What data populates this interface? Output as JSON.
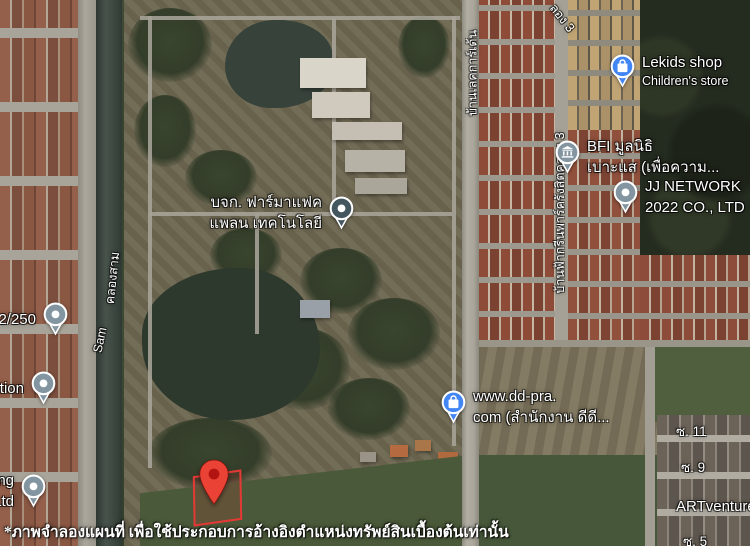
{
  "map": {
    "view": "satellite",
    "disclaimer": "*ภาพจำลองแผนที่ เพื่อใช้ประกอบการอ้างอิงตำแหน่งทรัพย์สินเบื้องต้นเท่านั้น",
    "pois": [
      {
        "line1": "Lekids shop",
        "line2": "Children's store",
        "icon": "shopping-bag",
        "pin_color": "#4285F4"
      },
      {
        "line1": "BFI มูลนิธิ",
        "line2": "เบาะแส (เพื่อความ...",
        "icon": "bank",
        "pin_color": "#8295A0"
      },
      {
        "line1": "JJ NETWORK",
        "line2": "2022 CO., LTD",
        "icon": "dot",
        "pin_color": "#8295A0"
      },
      {
        "line1": "บจก. ฟาร์มาแฟค",
        "line2": "แพลน เทคโนโลยี",
        "icon": "dot",
        "pin_color": "#44575E"
      },
      {
        "line1": "www.dd-pra.",
        "line2": "com (สำนักงาน ดีดี...",
        "icon": "shopping-bag",
        "pin_color": "#4285F4"
      },
      {
        "line1": "2/250",
        "line2": "",
        "icon": "dot",
        "pin_color": "#8295A0"
      },
      {
        "line1": "ution",
        "line2": "",
        "icon": "dot",
        "pin_color": "#8295A0"
      },
      {
        "line1": "ng",
        "line2": "Ltd",
        "icon": "dot",
        "pin_color": "#8295A0"
      }
    ],
    "road_labels": [
      {
        "text": "บ้านเลคการ์เด้น"
      },
      {
        "text": "บ้านฟ้ากรีนพาร์ครังสิตคลอง 3"
      },
      {
        "text": "คลองสาม"
      },
      {
        "text": "Sam"
      },
      {
        "text": "ลอง 3"
      }
    ],
    "street_labels": [
      {
        "text": "ซ. 11"
      },
      {
        "text": "ซ. 9"
      },
      {
        "text": "ARTventure"
      },
      {
        "text": "ซ. 5"
      }
    ],
    "marker": {
      "pin_color": "#EA4335",
      "inner_color": "#B31412",
      "boundary_color": "#E53935"
    },
    "colors": {
      "canal_water": "#3A453E",
      "field_green": "#4A5939",
      "roof_red": "#8D4B38",
      "roof_tan": "#C0A474",
      "road_gray": "#A8A49A",
      "woods_dark": "#242B1F"
    }
  }
}
